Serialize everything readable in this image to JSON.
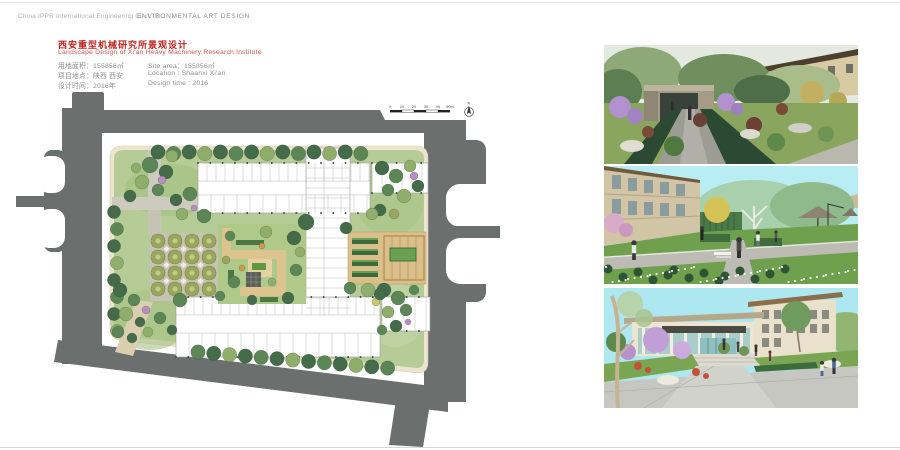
{
  "header": {
    "company": "China IPPR International Engineering Co.,LTD",
    "separator": "|",
    "division": "ENVIRONMENTAL ART DESIGN"
  },
  "title_block": {
    "title_cn": "西安重型机械研究所景观设计",
    "title_en": "Landscape Design of Xi'an Heavy Machinery Research Institute",
    "info_cn": [
      "用地面积：155856㎡",
      "项目地点：陕西 西安",
      "设计时间：2016年"
    ],
    "info_en": [
      "Site area：155856㎡",
      "Location : Shaanxi Xi'an",
      "Design time : 2016"
    ]
  },
  "site_plan": {
    "scale_ticks": [
      "0",
      "10",
      "20",
      "30",
      "40",
      "50m"
    ],
    "north_label": "N"
  },
  "renderings": [
    {
      "name": "garden-path-gateway-view"
    },
    {
      "name": "courtyard-garden-view"
    },
    {
      "name": "main-entrance-plaza-view"
    }
  ],
  "palette": {
    "title_red": "#c0251f",
    "road_gray": "#6b6f6e",
    "parcel_cream": "#ece4cf",
    "lawn_green": "#b5cc96",
    "tree_green": "#446b4a",
    "courtyard_tan": "#ddc48f",
    "sky_cyan": "#b9edf4"
  }
}
